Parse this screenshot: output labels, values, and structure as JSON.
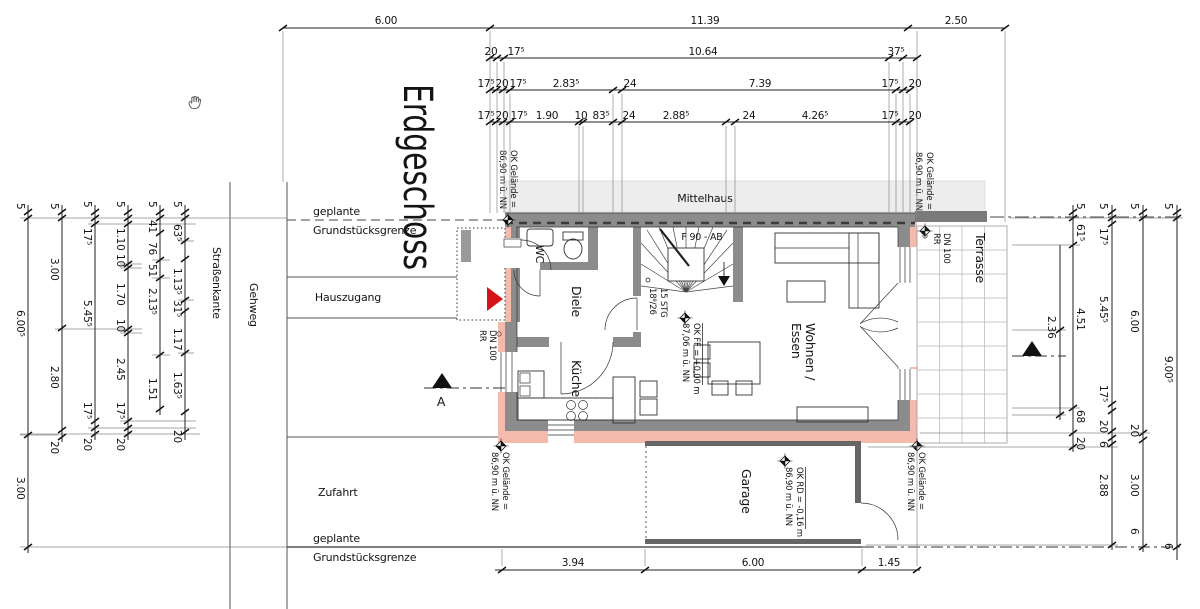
{
  "title": "Erdgeschoss",
  "site": {
    "mittelhaus": "Mittelhaus",
    "strassenkante": "Straßenkante",
    "gehweg": "Gehweg",
    "hauszugang": "Hauszugang",
    "zufahrt": "Zufahrt",
    "grenze_line1": "geplante",
    "grenze_line2": "Grundstücksgrenze",
    "section_label": "A"
  },
  "rooms": {
    "wc": "WC",
    "diele": "Diele",
    "kueche": "Küche",
    "wohnen_line1": "Wohnen /",
    "wohnen_line2": "Essen",
    "garage": "Garage",
    "terrasse": "Terrasse"
  },
  "stairs": {
    "fire_rating": "F 90 - AB",
    "steps_line1": "15 STG",
    "steps_line2": "18⁸/26"
  },
  "levels": {
    "ff_line1": "OK FF = +0,00 m",
    "ff_line2": "87,06 m ü. NN",
    "rd_line1": "OK RD = -0,16 m",
    "rd_line2": "86,90 m ü. NN",
    "gel_line1": "OK Gelände =",
    "gel_line2": "86,90 m ü. NN",
    "rr": "RR",
    "dn": "DN 100"
  },
  "dims": {
    "top1": [
      "6.00",
      "11.39",
      "2.50"
    ],
    "top2": [
      "20",
      "17⁵",
      "10.64",
      "37⁵"
    ],
    "top3": [
      "17⁵",
      "20",
      "17⁵",
      "2.83⁵",
      "24",
      "7.39",
      "17⁵",
      "20"
    ],
    "top4": [
      "17⁵",
      "20",
      "17⁵",
      "1.90",
      "10",
      "83⁵",
      "24",
      "2.88⁵",
      "24",
      "4.26⁵",
      "17⁵",
      "20"
    ],
    "bottom": [
      "3.94",
      "6.00",
      "1.45"
    ],
    "left1": [
      "5",
      "6.00⁵",
      "3.00"
    ],
    "left2": [
      "5",
      "3.00",
      "2.80",
      "20"
    ],
    "left3": [
      "5",
      "17⁵",
      "5.45⁵",
      "17⁵",
      "20"
    ],
    "left4": [
      "5",
      "1.10",
      "10",
      "1.70",
      "10",
      "2.45",
      "17⁵",
      "20"
    ],
    "left5": [
      "5",
      "41",
      "76",
      "51",
      "2.13⁵",
      "1.51"
    ],
    "left6": [
      "5",
      "63⁵",
      "1.13⁵",
      "31⁵",
      "1.17",
      "1.63⁵",
      "20"
    ],
    "right1": [
      "5",
      "61⁵",
      "2.36",
      "4.51",
      "68",
      "20"
    ],
    "right2": [
      "5",
      "17⁵",
      "5.45⁵",
      "17⁵",
      "20",
      "6",
      "2.88"
    ],
    "right3": [
      "5",
      "6.00",
      "20",
      "3.00",
      "6"
    ],
    "right4": [
      "5",
      "9.00⁵",
      "6"
    ]
  }
}
